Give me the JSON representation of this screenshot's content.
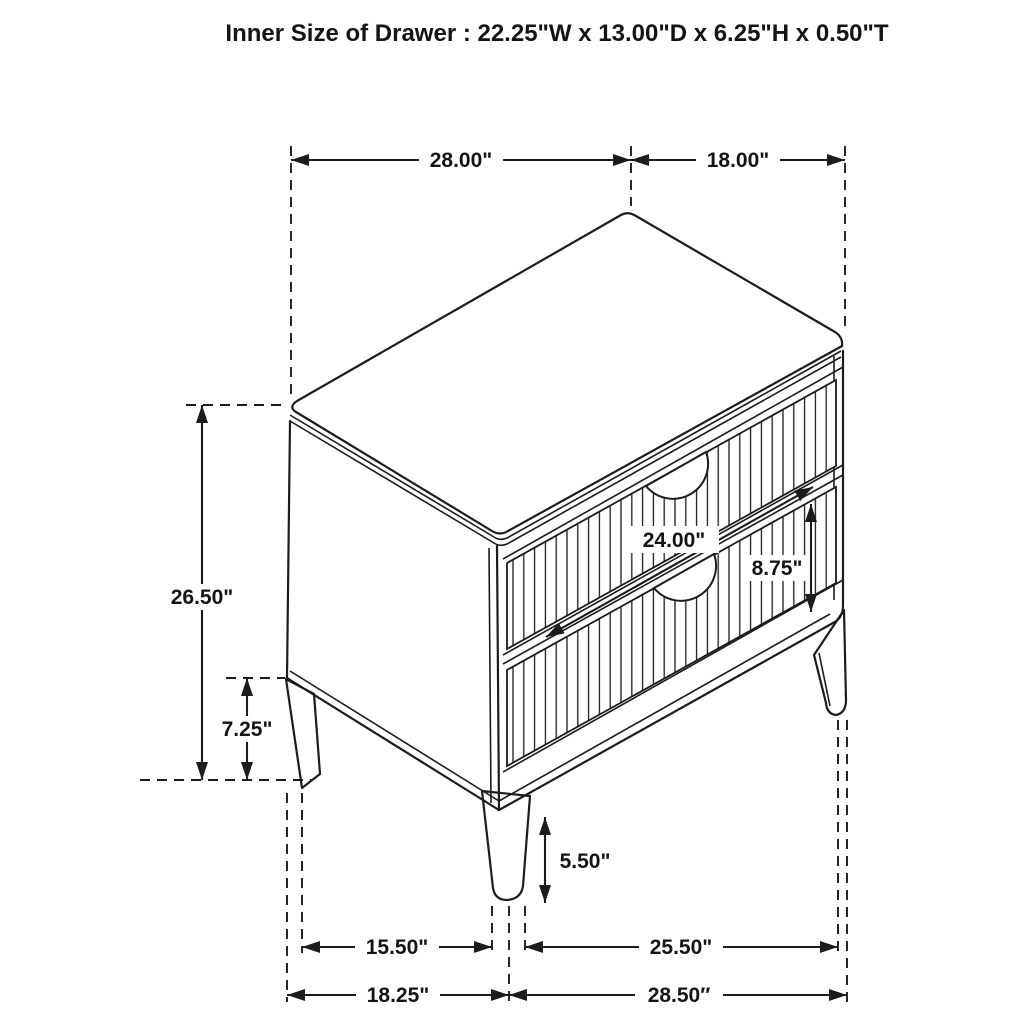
{
  "title": "Inner Size of Drawer : 22.25\"W x 13.00\"D x 6.25\"H x 0.50\"T",
  "figure": {
    "type": "product-dimension-diagram",
    "subject": "two-drawer nightstand, isometric line drawing",
    "units": "inches",
    "line_color": "#1c1c1c",
    "background_color": "#ffffff"
  },
  "dimensions": {
    "top_width": "28.00\"",
    "top_depth": "18.00\"",
    "overall_height": "26.50\"",
    "side_leg_height": "7.25\"",
    "drawer_front_width": "24.00\"",
    "drawer_front_height": "8.75\"",
    "front_leg_height": "5.50\"",
    "leg_span_side": "15.50\"",
    "leg_span_front": "25.50\"",
    "overall_depth": "18.25\"",
    "overall_width": "28.50″"
  }
}
